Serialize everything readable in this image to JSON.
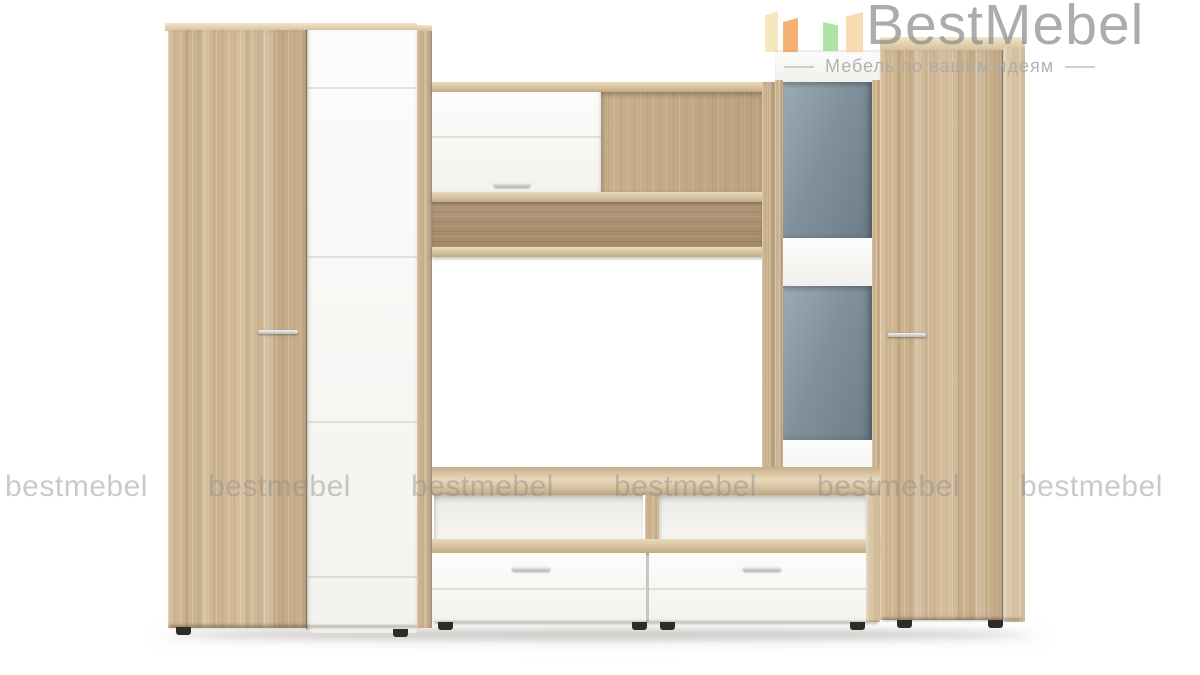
{
  "logo": {
    "name": "BestMebel",
    "tagline": "Мебель по вашим идеям",
    "text_color": "#8a8a8a",
    "tagline_color": "#ababab",
    "icon": {
      "name": "logo-bars-icon",
      "bars": [
        {
          "name": "pale-yellow-bar",
          "color": "#f3e2ab"
        },
        {
          "name": "orange-bar",
          "color": "#f09b4a"
        },
        {
          "name": "green-bar",
          "color": "#97dd8d"
        },
        {
          "name": "peach-bar",
          "color": "#f6d0a0"
        }
      ]
    }
  },
  "watermark": {
    "text": "bestmebel",
    "count": 6,
    "color": "#8c8c8c"
  },
  "product": {
    "type": "wall-unit-wardrobe-set",
    "palette": {
      "wood_base": "#cdb390",
      "wood_light": "#e3d2b2",
      "wood_dark": "#b59a7a",
      "back_panel": "#c2a986",
      "back_panel_dark": "#aa8f71",
      "white_front": "#fafaf8",
      "glass_top": "#97a4ad",
      "glass_bottom": "#6c7c86",
      "handle": "#b9b9b9",
      "foot": "#2e2c29"
    }
  }
}
